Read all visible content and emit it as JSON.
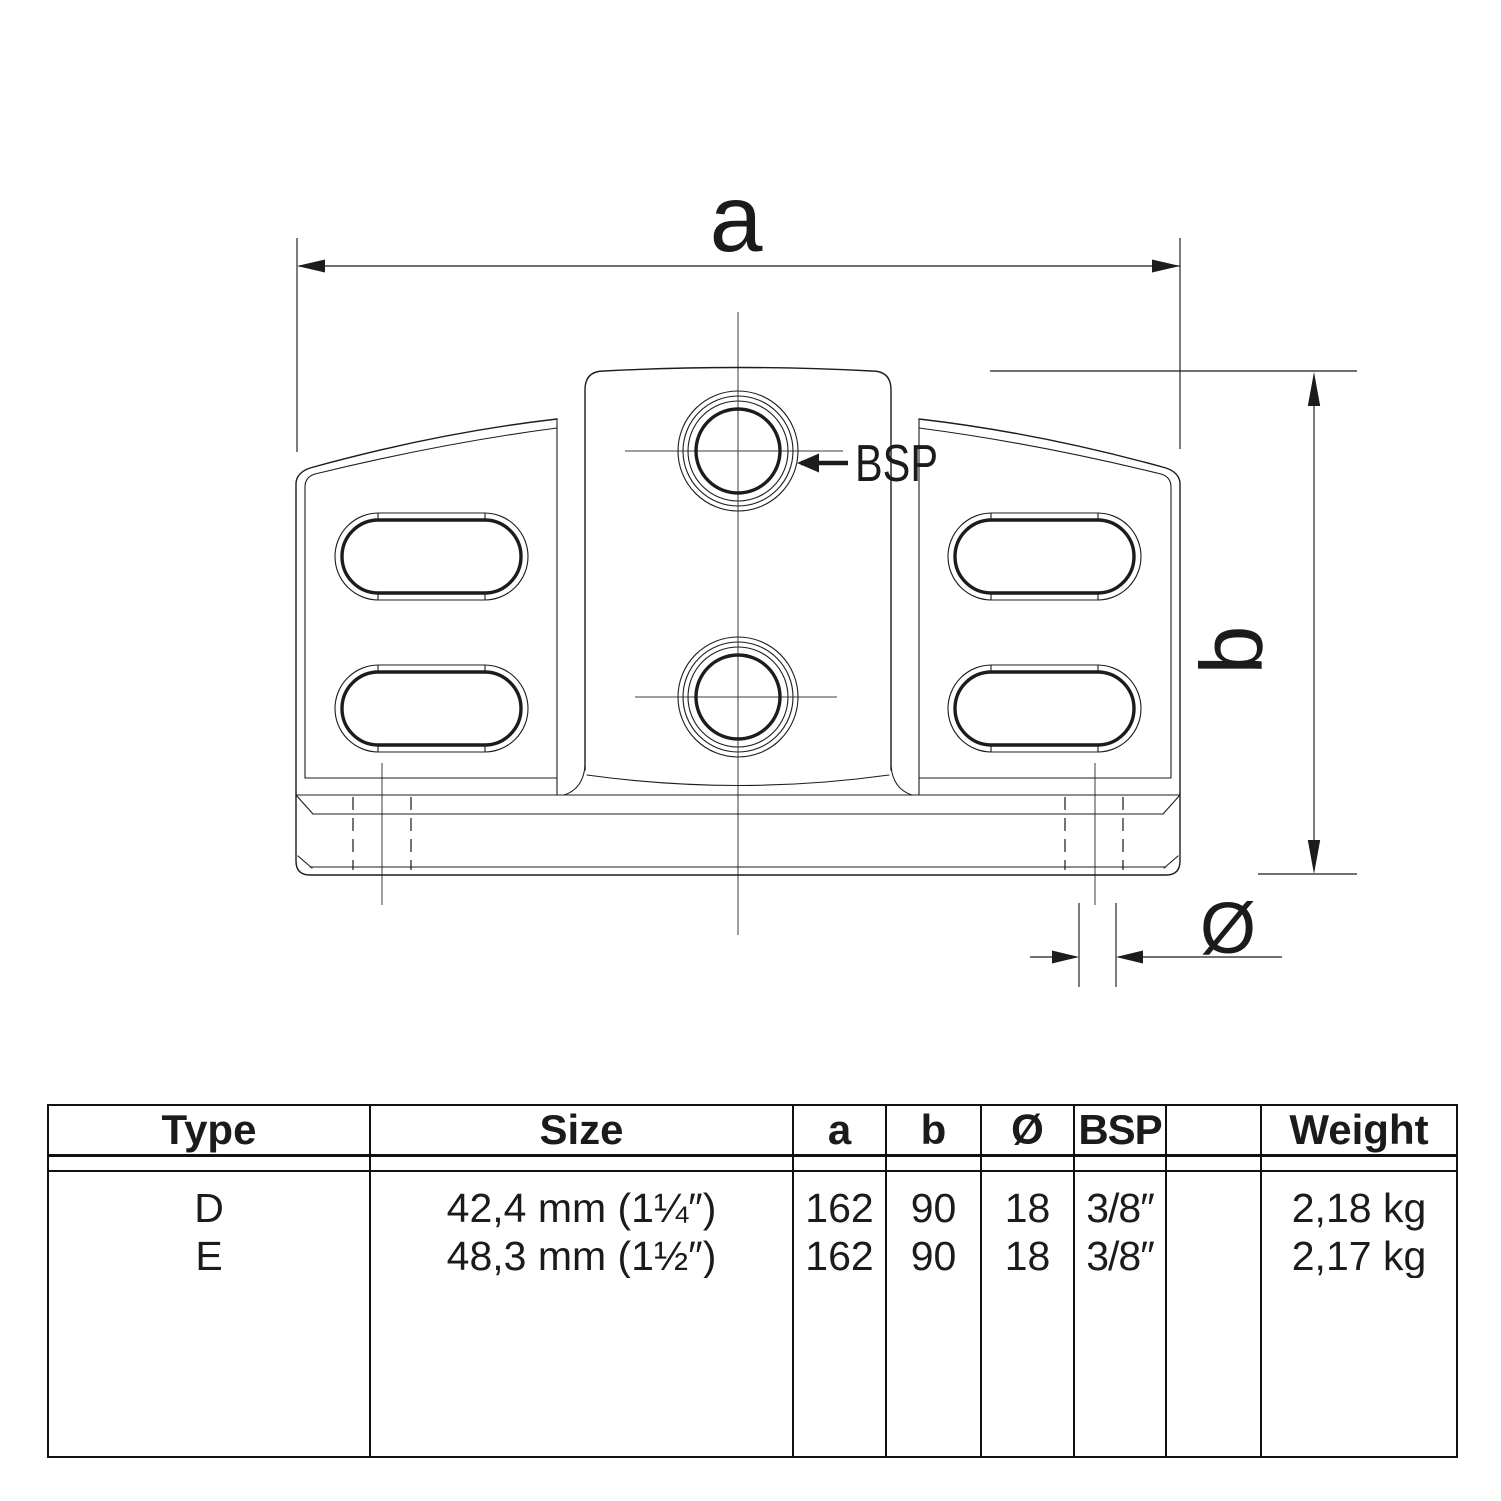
{
  "drawing": {
    "dim_a_label": "a",
    "dim_b_label": "b",
    "dim_dia_label": "Ø",
    "bsp_label": "BSP"
  },
  "table": {
    "headers": {
      "type": "Type",
      "size": "Size",
      "a": "a",
      "b": "b",
      "dia": "Ø",
      "bsp": "BSP",
      "spare": "",
      "weight": "Weight"
    },
    "rows": [
      {
        "type": "D",
        "size": "42,4 mm (1¼″)",
        "a": "162",
        "b": "90",
        "dia": "18",
        "bsp": "3/8″",
        "spare": "",
        "weight": "2,18 kg"
      },
      {
        "type": "E",
        "size": "48,3 mm (1½″)",
        "a": "162",
        "b": "90",
        "dia": "18",
        "bsp": "3/8″",
        "spare": "",
        "weight": "2,17 kg"
      }
    ]
  },
  "colors": {
    "ink": "#1b1b1b",
    "background": "#ffffff"
  }
}
